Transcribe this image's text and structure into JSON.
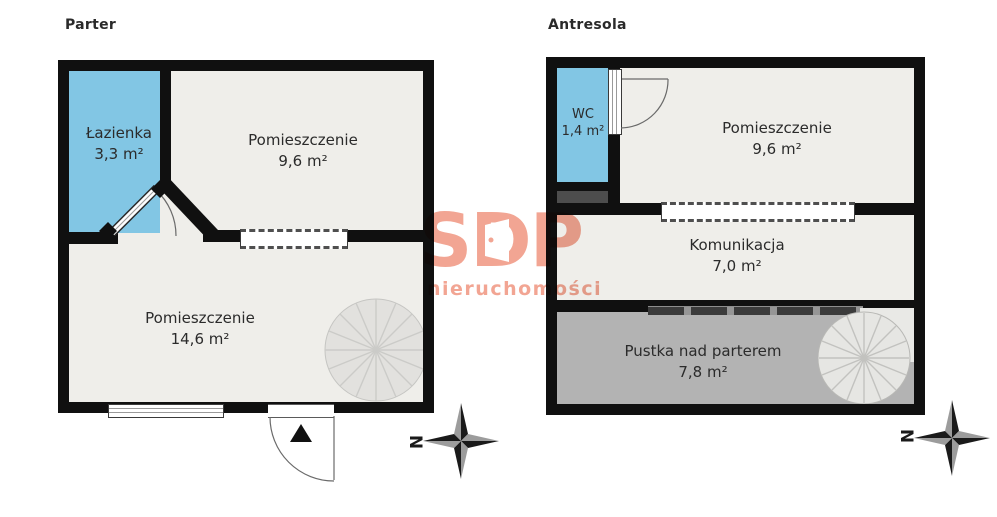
{
  "watermark": {
    "brand": "SDP",
    "tagline": "nieruchomości",
    "color": "#F2A593"
  },
  "plans": [
    {
      "title": "Parter",
      "compass": "N",
      "rooms": [
        {
          "name": "Łazienka",
          "area": "3,3 m²"
        },
        {
          "name": "Pomieszczenie",
          "area": "9,6 m²"
        },
        {
          "name": "Pomieszczenie",
          "area": "14,6 m²"
        }
      ]
    },
    {
      "title": "Antresola",
      "compass": "N",
      "rooms": [
        {
          "name": "WC",
          "area": "1,4 m²"
        },
        {
          "name": "Pomieszczenie",
          "area": "9,6 m²"
        },
        {
          "name": "Komunikacja",
          "area": "7,0 m²"
        },
        {
          "name": "Pustka nad parterem",
          "area": "7,8 m²"
        }
      ]
    }
  ],
  "colors": {
    "wall": "#101010",
    "floor": "#EFEEEA",
    "bathroom_fill": "#82C6E4",
    "void_fill": "#B3B3B3",
    "shaft_fill": "#4D4D4D",
    "watermark": "#F2A593"
  }
}
